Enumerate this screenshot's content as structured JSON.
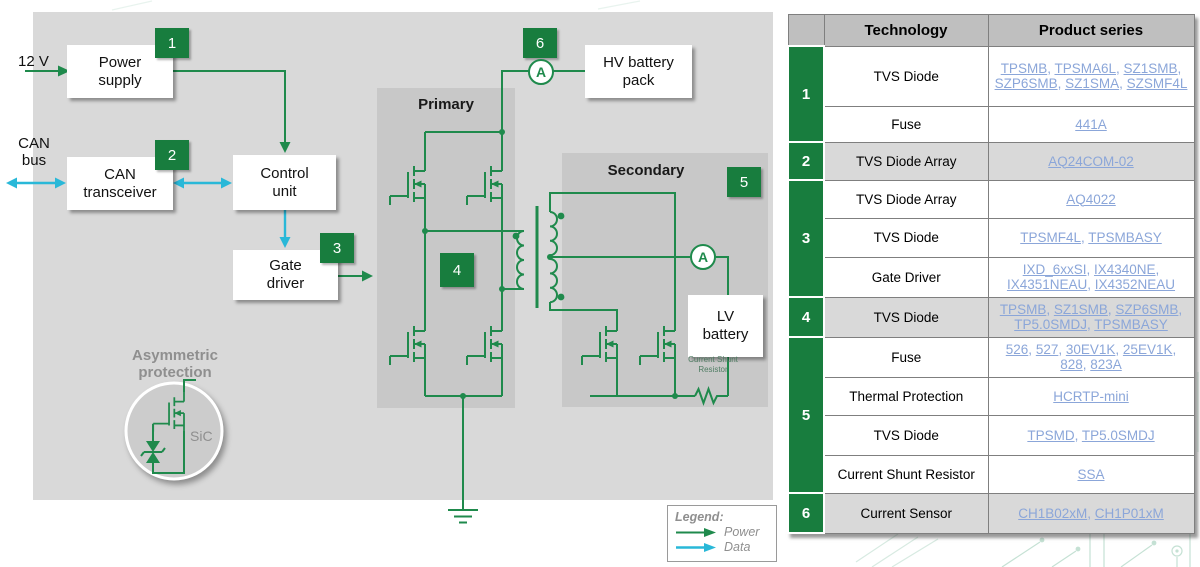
{
  "colors": {
    "green": "#1f8a4c",
    "badge_green": "#187d3e",
    "cyan": "#29b8d8",
    "link_blue": "#8ba6d9",
    "diagram_bg": "#d9d9d9",
    "block_bg": "#c8c8c8",
    "table_header_bg": "#bfbfbf",
    "row_shade": "#d9d9d9",
    "border_gray": "#7f7f7f",
    "muted_gray": "#8f8f8f",
    "shunt_green": "#4f7d63"
  },
  "diagram": {
    "labels": {
      "supply_voltage": "12 V",
      "can_bus": "CAN bus",
      "primary": "Primary",
      "secondary": "Secondary",
      "asymmetric_protection": "Asymmetric protection",
      "sic": "SiC",
      "current_shunt": "Current Shunt Resistor",
      "ammeter": "A"
    },
    "blocks": {
      "power_supply": "Power supply",
      "can_transceiver": "CAN transceiver",
      "control_unit": "Control unit",
      "gate_driver": "Gate driver",
      "hv_battery": "HV battery pack",
      "lv_battery": "LV battery"
    },
    "badges": [
      "1",
      "2",
      "3",
      "4",
      "5",
      "6"
    ],
    "legend": {
      "title": "Legend:",
      "power": "Power",
      "data": "Data"
    }
  },
  "table": {
    "headers": {
      "technology": "Technology",
      "product_series": "Product series"
    },
    "groups": [
      {
        "num": "1",
        "shade": false,
        "rows": [
          {
            "tech": "TVS Diode",
            "links": [
              "TPSMB",
              "TPSMA6L",
              "SZ1SMB",
              "SZP6SMB",
              "SZ1SMA",
              "SZSMF4L"
            ]
          },
          {
            "tech": "Fuse",
            "links": [
              "441A"
            ]
          }
        ]
      },
      {
        "num": "2",
        "shade": true,
        "rows": [
          {
            "tech": "TVS Diode Array",
            "links": [
              "AQ24COM-02"
            ]
          }
        ]
      },
      {
        "num": "3",
        "shade": false,
        "rows": [
          {
            "tech": "TVS Diode Array",
            "links": [
              "AQ4022"
            ]
          },
          {
            "tech": "TVS Diode",
            "links": [
              "TPSMF4L",
              "TPSMBASY"
            ]
          },
          {
            "tech": "Gate Driver",
            "links": [
              "IXD_6xxSI",
              "IX4340NE",
              "IX4351NEAU",
              "IX4352NEAU"
            ]
          }
        ]
      },
      {
        "num": "4",
        "shade": true,
        "rows": [
          {
            "tech": "TVS Diode",
            "links": [
              "TPSMB",
              "SZ1SMB",
              "SZP6SMB",
              "TP5.0SMDJ",
              "TPSMBASY"
            ]
          }
        ]
      },
      {
        "num": "5",
        "shade": false,
        "rows": [
          {
            "tech": "Fuse",
            "links": [
              "526",
              "527",
              "30EV1K",
              "25EV1K",
              "828",
              "823A"
            ]
          },
          {
            "tech": "Thermal Protection",
            "links": [
              "HCRTP-mini"
            ]
          },
          {
            "tech": "TVS Diode",
            "links": [
              "TPSMD",
              "TP5.0SMDJ"
            ]
          },
          {
            "tech": "Current Shunt Resistor",
            "links": [
              "SSA"
            ]
          }
        ]
      },
      {
        "num": "6",
        "shade": true,
        "rows": [
          {
            "tech": "Current Sensor",
            "links": [
              "CH1B02xM",
              "CH1P01xM"
            ]
          }
        ]
      }
    ]
  }
}
